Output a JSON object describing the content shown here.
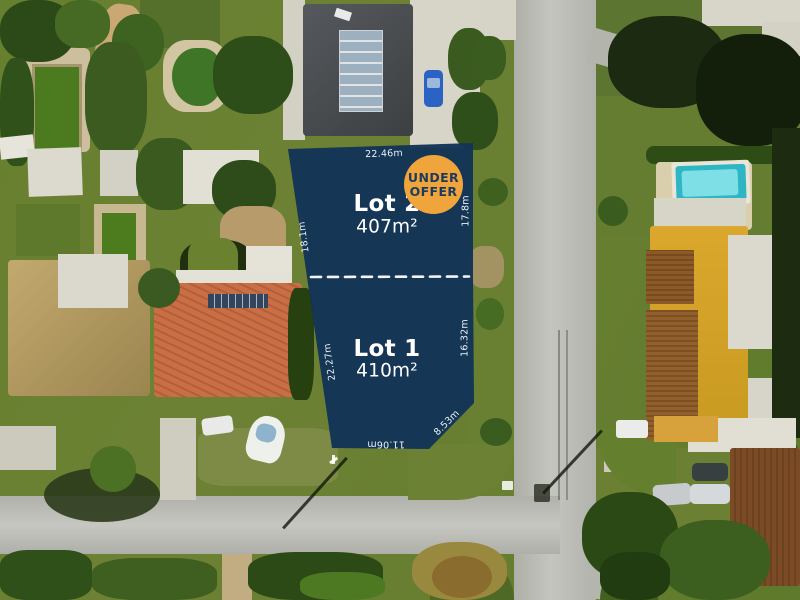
{
  "overlay": {
    "badge": {
      "line1": "UNDER",
      "line2": "OFFER"
    },
    "lots": {
      "lot2": {
        "title": "Lot 2",
        "area": "407m²"
      },
      "lot1": {
        "title": "Lot 1",
        "area": "410m²"
      }
    },
    "measurements": {
      "lot2_top": "22.46m",
      "lot2_left": "18.1m",
      "lot2_right": "17.8m",
      "lot1_left": "22.27m",
      "lot1_right": "16.32m",
      "lot1_corner": "8.53m",
      "lot1_bottom": "11.06m"
    },
    "colors": {
      "lot_fill": "#123356",
      "badge_bg": "#f0a43c",
      "badge_text": "#1c3a5e",
      "label_text": "#ffffff",
      "divider": "#ffffff"
    }
  }
}
